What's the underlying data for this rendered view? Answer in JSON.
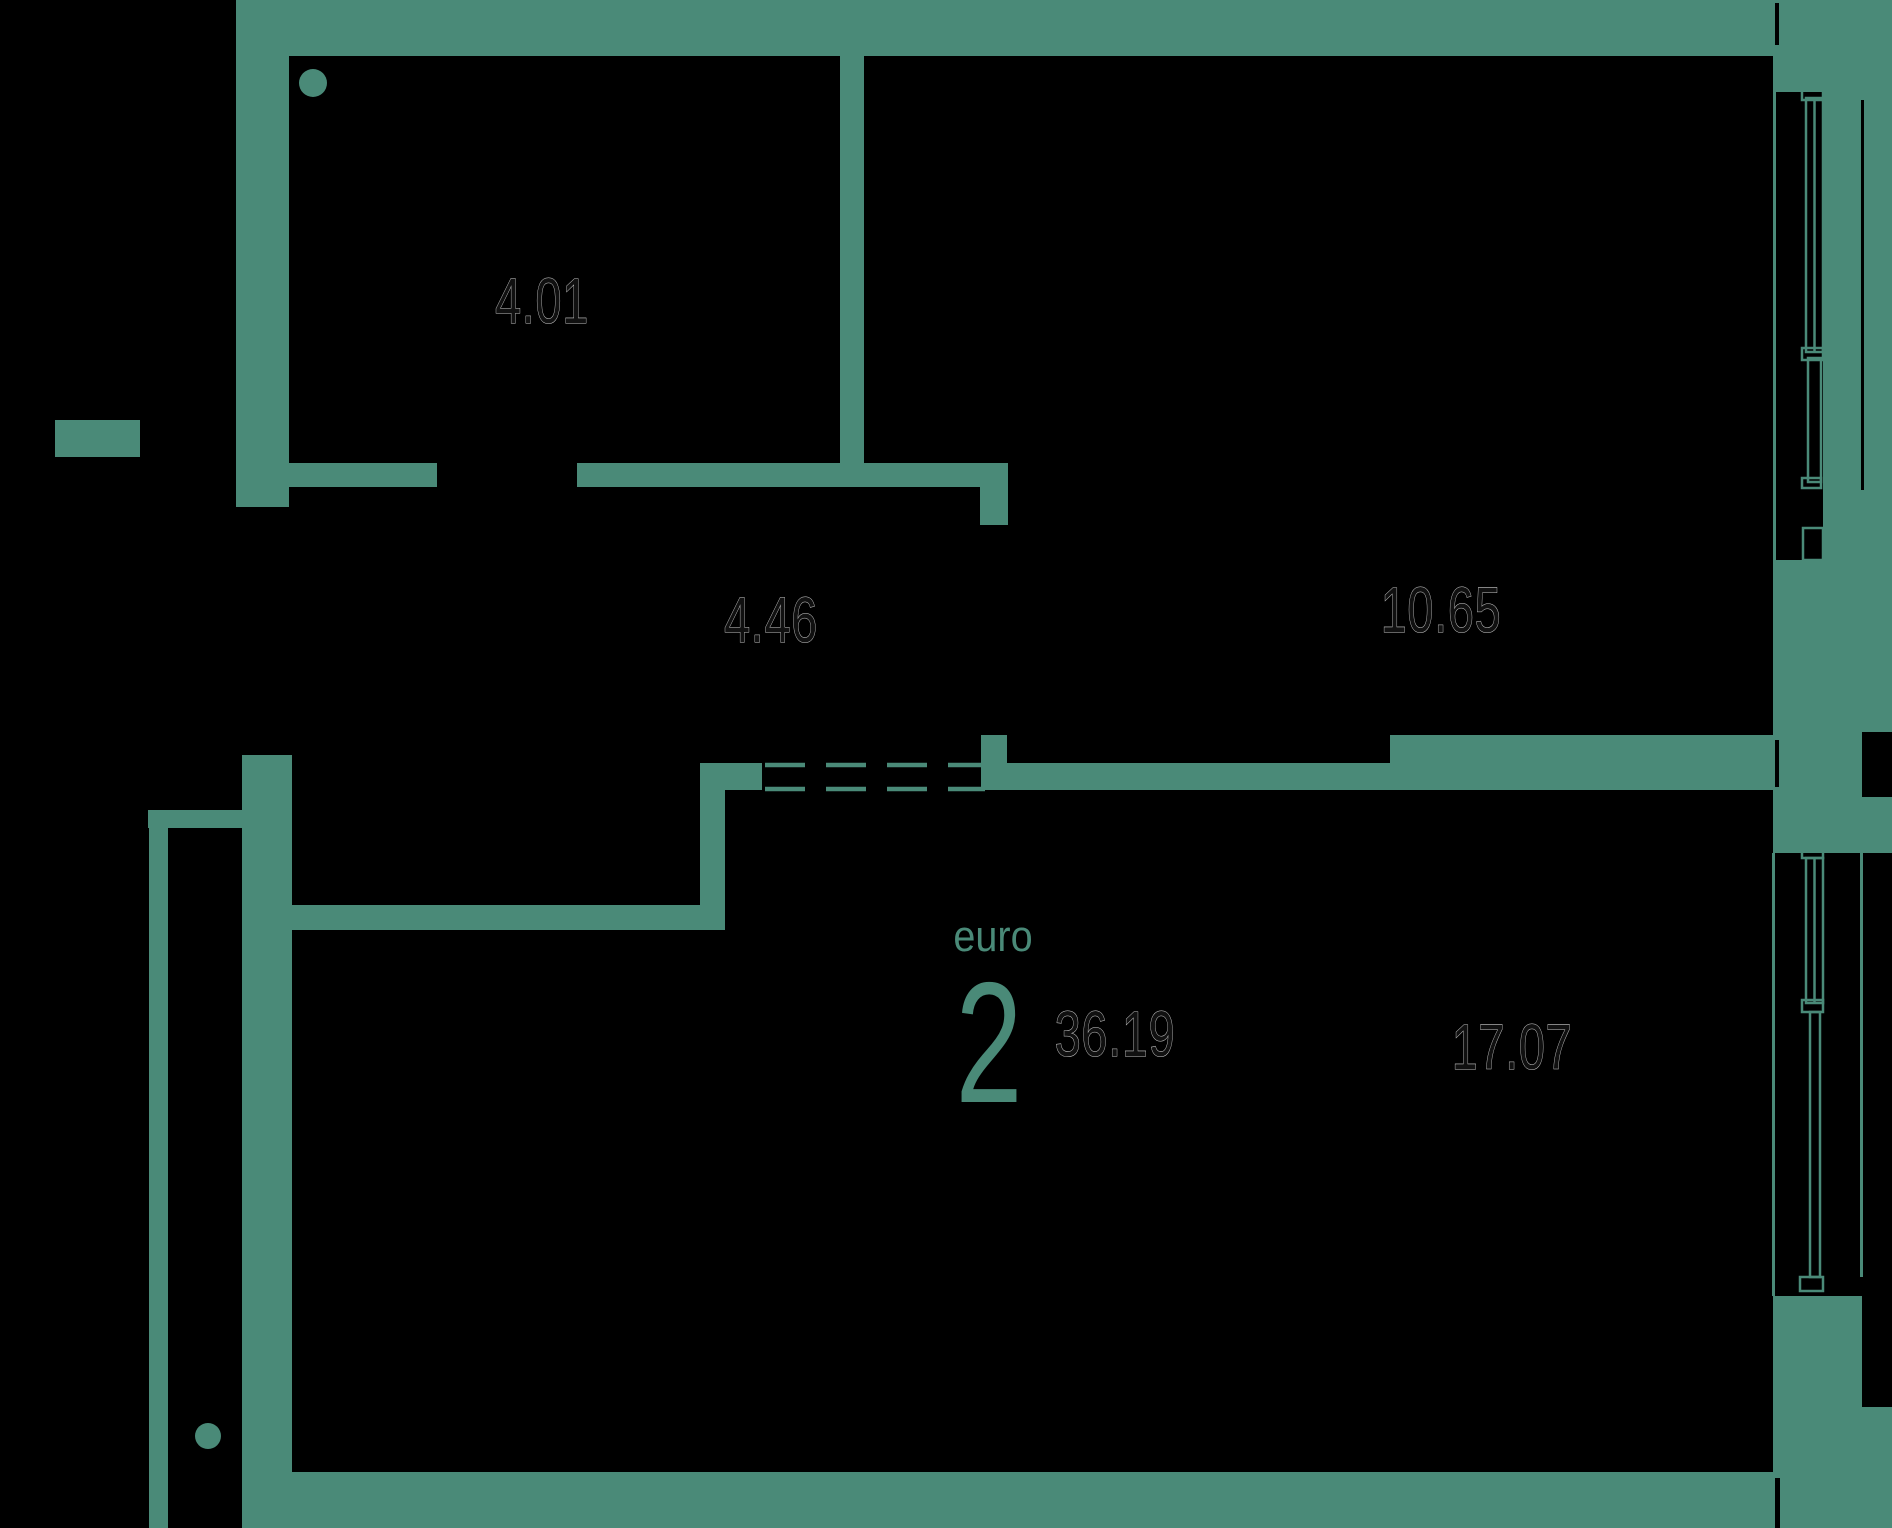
{
  "plan": {
    "layout_label": "euro",
    "rooms_count": "2",
    "total_area": "36.19",
    "room_areas": [
      "4.01",
      "4.46",
      "10.65",
      "17.07"
    ]
  },
  "colors": {
    "wall": "#4a8a78",
    "background": "#000000",
    "area_label_fill": "#101010",
    "area_label_outline": "#c9c9c9"
  }
}
